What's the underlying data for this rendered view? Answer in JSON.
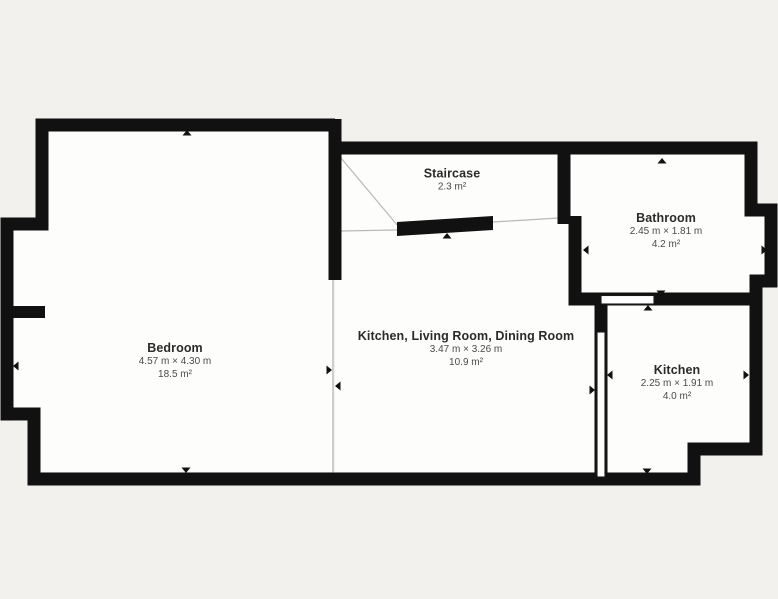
{
  "plan": {
    "type": "floor-plan",
    "rooms": [
      {
        "name": "Bedroom",
        "dimensions": "4.57 m × 4.30 m",
        "area": "18.5 m²"
      },
      {
        "name": "Staircase",
        "area": "2.3 m²"
      },
      {
        "name": "Kitchen, Living Room, Dining Room",
        "dimensions": "3.47 m × 3.26 m",
        "area": "10.9 m²"
      },
      {
        "name": "Bathroom",
        "dimensions": "2.45 m × 1.81 m",
        "area": "4.2 m²"
      },
      {
        "name": "Kitchen",
        "dimensions": "2.25 m × 1.91 m",
        "area": "4.0 m²"
      }
    ]
  },
  "colors": {
    "background": "#f3f1ee",
    "wall": "#111111",
    "floor": "#fdfdfc",
    "room_name_text": "#2b2b2b",
    "dimension_text": "#4a4a4a"
  }
}
